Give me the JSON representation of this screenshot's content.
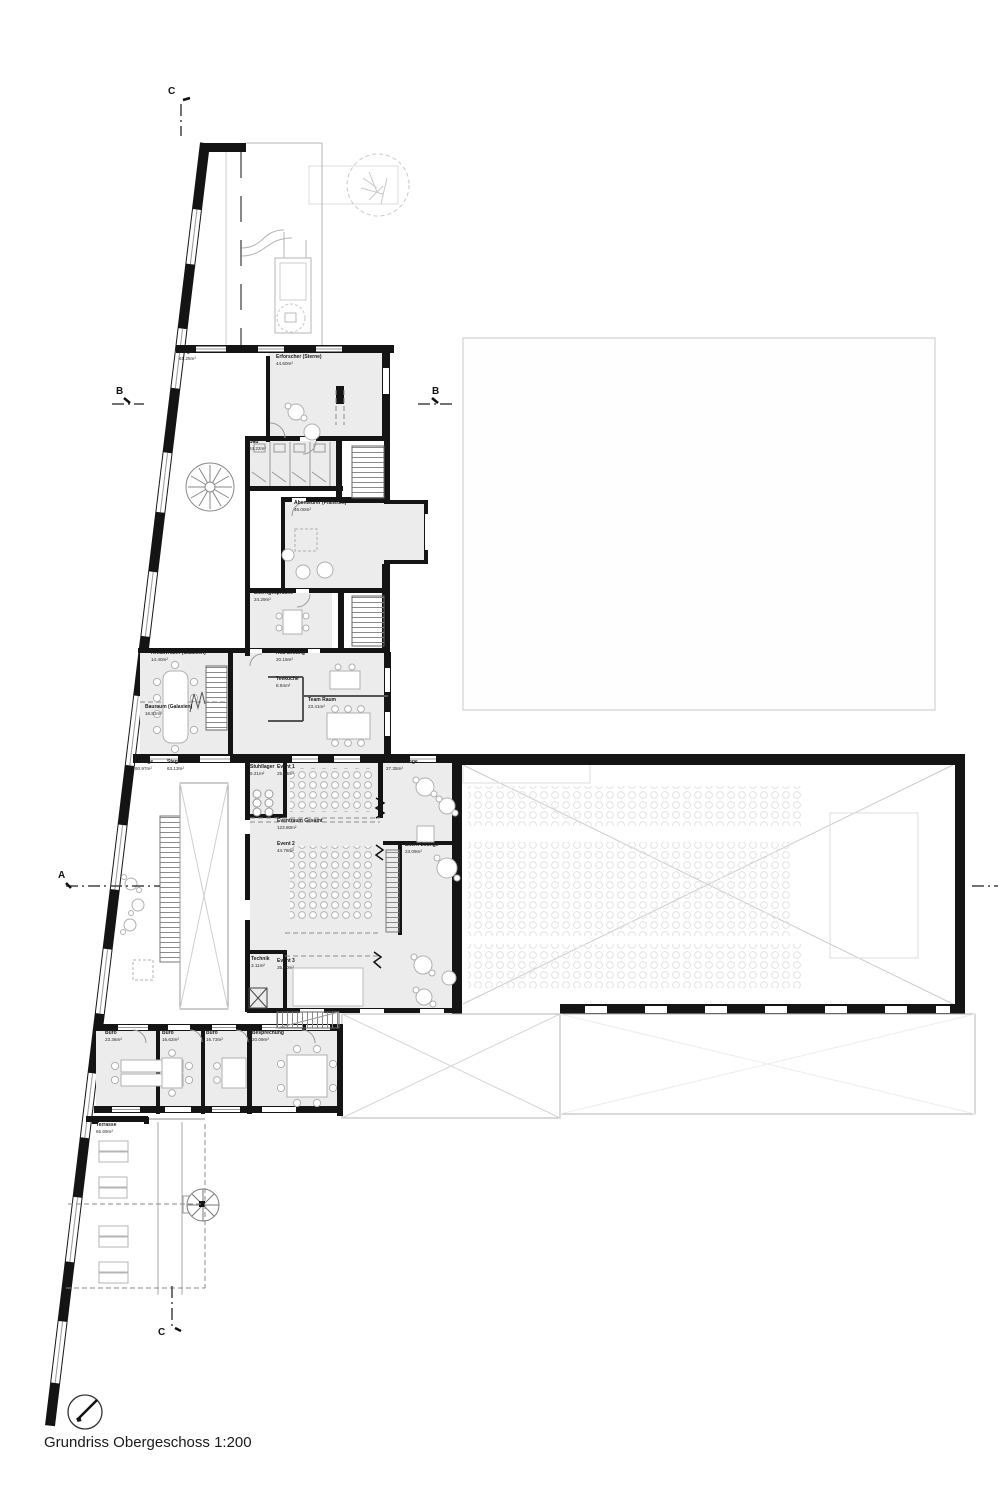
{
  "title": "Grundriss Obergeschoss 1:200",
  "markers": {
    "a": "A",
    "b": "B",
    "c": "C"
  },
  "rooms": [
    {
      "name": "Steg",
      "area": "61.25m²"
    },
    {
      "name": "Erforscher (Sterne)",
      "area": "44.60m²"
    },
    {
      "name": "Bad",
      "area": "24.22m²"
    },
    {
      "name": "Abenteurer (Planeten)",
      "area": "45.00m²"
    },
    {
      "name": "Elterngespräche",
      "area": "24.29m²"
    },
    {
      "name": "Kreativraum (Galaxien)",
      "area": "14.40m²"
    },
    {
      "name": "Bauraum (Galaxien)",
      "area": "16.83m²"
    },
    {
      "name": "Kita Leitung",
      "area": "20.16m²"
    },
    {
      "name": "Teeküche",
      "area": "8.84m²"
    },
    {
      "name": "Team Raum",
      "area": "23.41m²"
    },
    {
      "name": "Lounge",
      "area": "60.97m²"
    },
    {
      "name": "Steg",
      "area": "63.13m²"
    },
    {
      "name": "Stuhllager",
      "area": "5.21m²"
    },
    {
      "name": "Event 1",
      "area": "25.43m²"
    },
    {
      "name": "Eventraum Gesamt",
      "area": "123.80m²"
    },
    {
      "name": "Event 2",
      "area": "44.78m²"
    },
    {
      "name": "Still - Lounge",
      "area": "27.35m²"
    },
    {
      "name": "Eltern Lounge",
      "area": "23.09m²"
    },
    {
      "name": "Technik",
      "area": "3.11m²"
    },
    {
      "name": "Event 3",
      "area": "35.80m²"
    },
    {
      "name": "Büro",
      "area": "23.36m²"
    },
    {
      "name": "Büro",
      "area": "16.62m²"
    },
    {
      "name": "Büro",
      "area": "16.73m²"
    },
    {
      "name": "Besprechung",
      "area": "20.09m²"
    },
    {
      "name": "Terrasse",
      "area": "65.69m²"
    }
  ]
}
